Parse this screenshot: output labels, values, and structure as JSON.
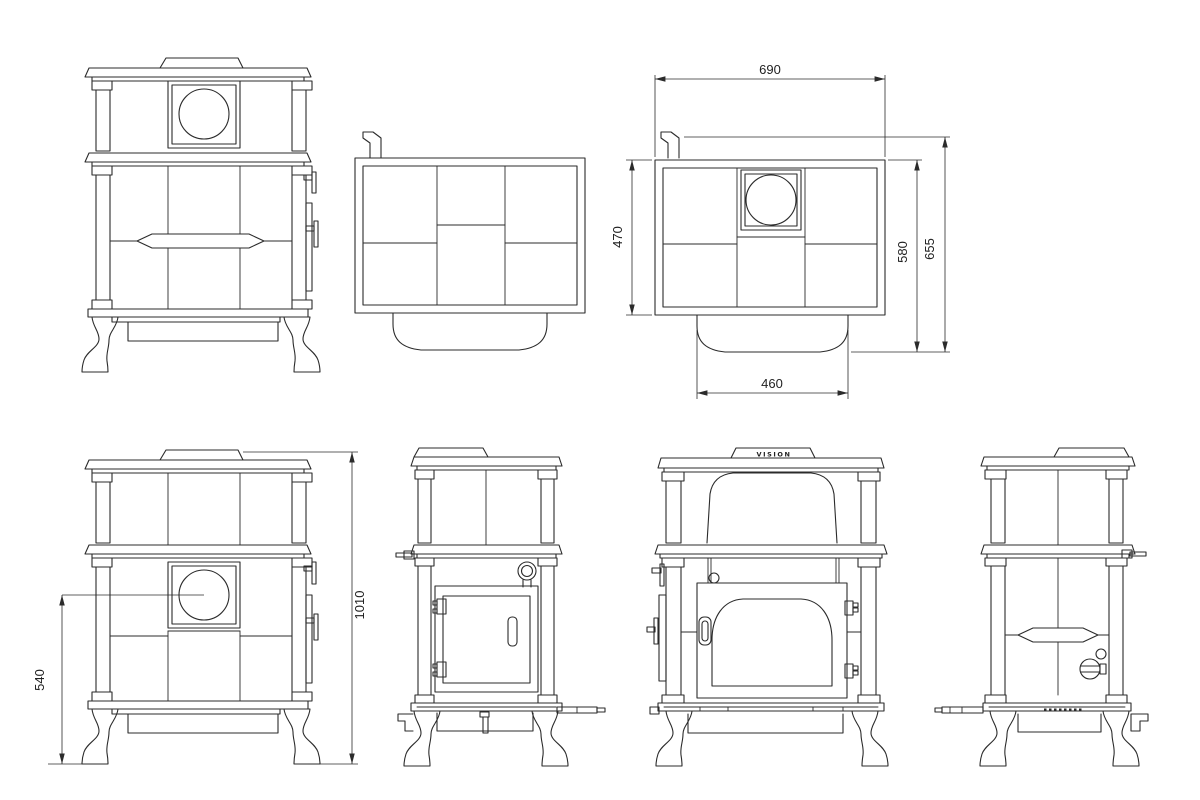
{
  "drawing": {
    "brand": "VISION",
    "dimensions": {
      "top_width": "690",
      "top_depth": "470",
      "depth_with_front": "580",
      "overall_depth": "655",
      "front_base_width": "460",
      "port_height": "540",
      "overall_height": "1010"
    }
  }
}
